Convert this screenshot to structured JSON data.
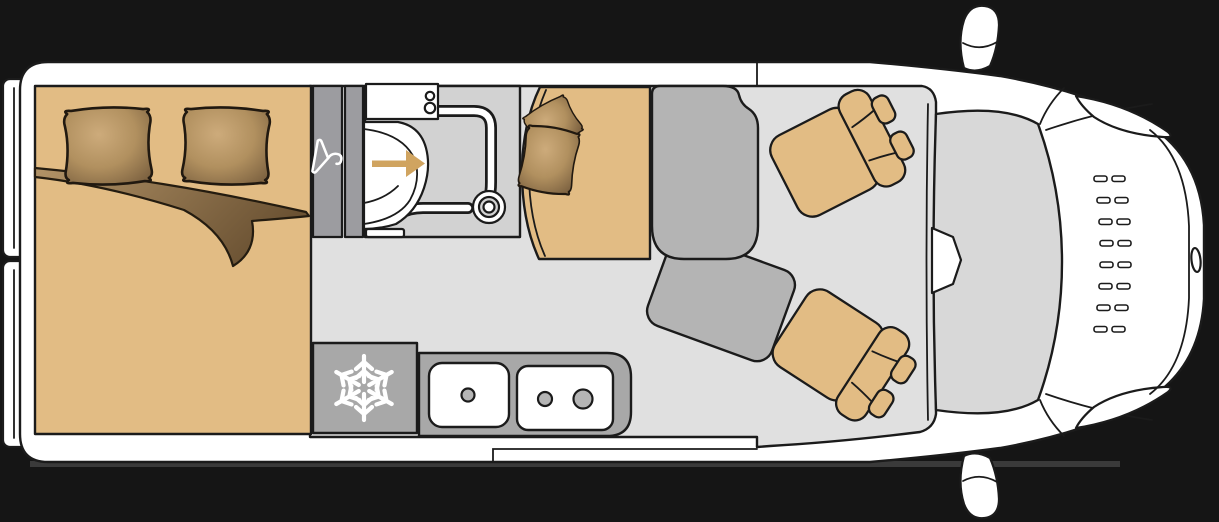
{
  "diagram": {
    "type": "campervan-floorplan-top-view",
    "colors": {
      "background": "#151515",
      "body": "#ffffff",
      "outline": "#1b1b1b",
      "floor": "#e0e0e0",
      "bathroom_floor": "#d2d2d2",
      "windshield": "#d8d8d8",
      "cabinet_gray": "#9c9ca0",
      "seat_gray": "#b4b4b4",
      "appliance_gray": "#a8a8a8",
      "burner_gray": "#b5b5b5",
      "upholstery_tan": "#e2bc84",
      "arrow_tan": "#d0a460",
      "icon_white": "#ffffff",
      "shadow": "#3a3a3a"
    },
    "areas": {
      "bed": {
        "name": "rear-double-bed",
        "pillows": 2,
        "extras": [
          "folded-blanket"
        ]
      },
      "wardrobe": {
        "name": "wardrobe",
        "icon": "hanger-icon"
      },
      "bathroom": {
        "name": "bathroom",
        "fixtures": [
          "washbasin",
          "swivel-toilet",
          "shower-rail",
          "shower-drain"
        ],
        "icon": "arrow-right-icon"
      },
      "lounge": {
        "name": "dinette",
        "fixtures": [
          "side-bench-with-two-cushions",
          "belted-bench-seat",
          "table"
        ]
      },
      "kitchen": {
        "name": "kitchenette",
        "fixtures": [
          "refrigerator",
          "sink",
          "two-burner-hob"
        ],
        "icon": "snowflake-icon"
      },
      "cab": {
        "name": "driver-cab",
        "fixtures": [
          "swivel-passenger-seat",
          "swivel-driver-seat",
          "windshield",
          "rear-view-mirror",
          "wing-mirror-top",
          "wing-mirror-bottom",
          "headlights",
          "bonnet-vents",
          "front-badge"
        ]
      },
      "doors": {
        "name": "rear-doors",
        "count": 2
      }
    }
  }
}
